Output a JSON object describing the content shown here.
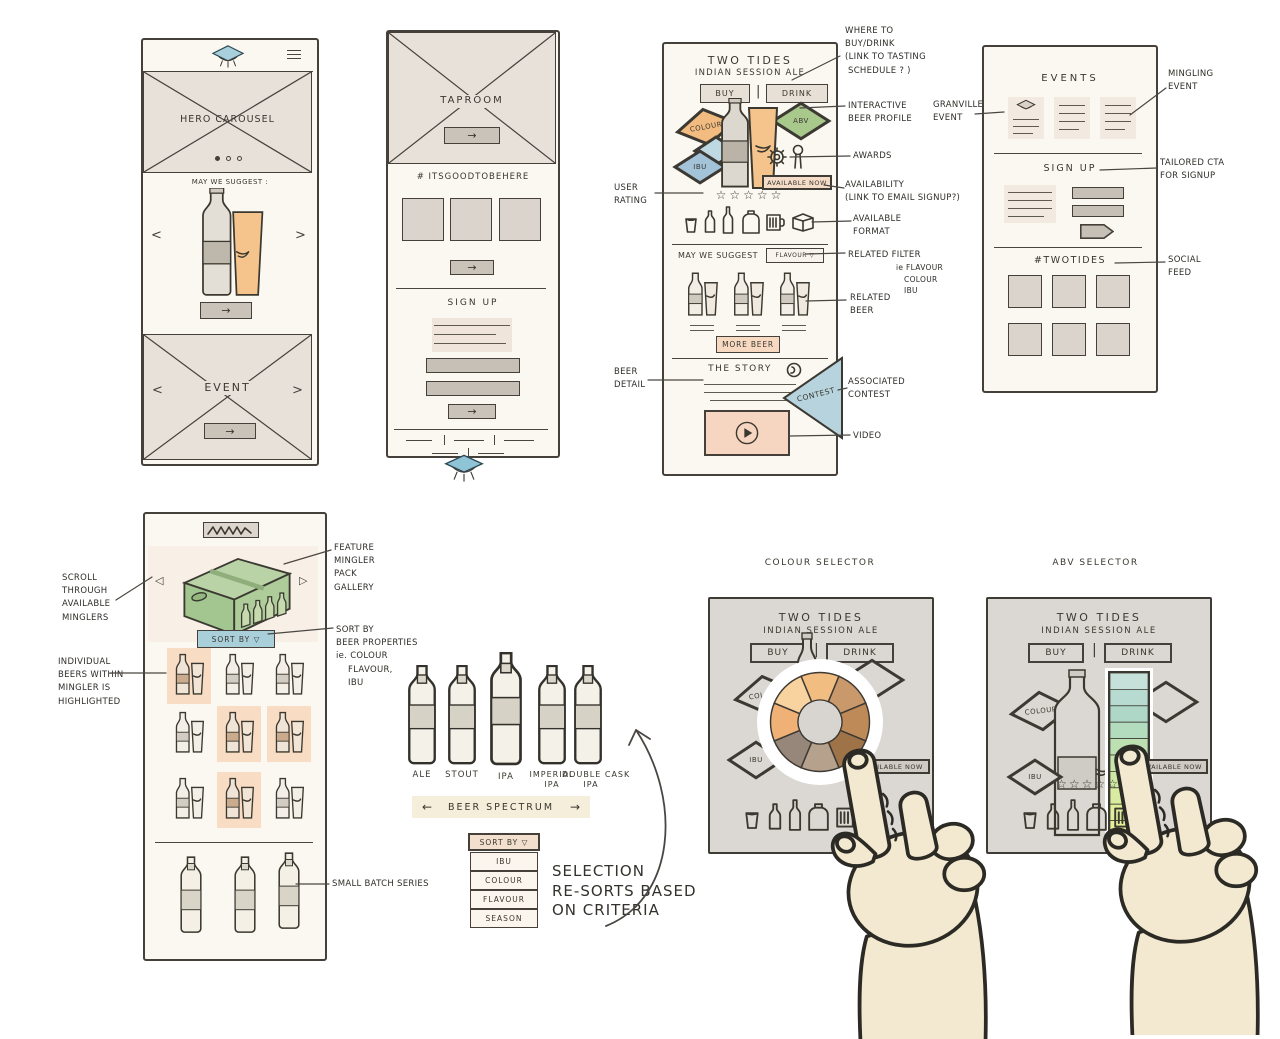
{
  "icons": {
    "right_arrow": "→",
    "left_arrow": "←",
    "prev_chevron": "<",
    "next_chevron": ">",
    "prev_triangle": "◁",
    "next_triangle": "▷",
    "pipe_divider": "|"
  },
  "colors": {
    "ink": "#3a372f",
    "paper": "#fbf7f1",
    "placeholder_gray": "#e8e1da",
    "accent_blue": "#a9cfdd",
    "diamond_orange": "#f2bc80",
    "diamond_green": "#a8c88c",
    "diamond_blue": "#a3c3d9",
    "highlight_peach": "#f9dcc4",
    "video_peach": "#f6d6c0",
    "contest_blue": "#b7d3de",
    "pack_green": "#aecb9a",
    "sort_button_blue": "#a9cfdb",
    "hand_skin": "#f2e9d0",
    "selector_card_gray": "#dbd7d2"
  },
  "phone_home": {
    "hero_label": "HERO CAROUSEL",
    "suggest_heading": "MAY WE SUGGEST :",
    "event_label": "EVENT"
  },
  "phone_taproom": {
    "taproom_label": "TAPROOM",
    "hashtag_heading": "# ITSGOODTOBEHERE",
    "signup_heading": "SIGN UP"
  },
  "phone_beer": {
    "title": "TWO TIDES",
    "subtitle": "INDIAN SESSION ALE",
    "buy_label": "BUY",
    "drink_label": "DRINK",
    "colour_diamond": "COLOUR",
    "abv_diamond": "ABV",
    "ibu_diamond": "IBU",
    "available_now": "AVAILABLE NOW",
    "rating_stars": "☆☆☆☆☆",
    "suggest_heading": "MAY WE SUGGEST",
    "related_filter": "FLAVOUR ▽",
    "more_beer": "MORE BEER",
    "story_heading": "THE STORY",
    "contest_label": "CONTEST"
  },
  "phone_events": {
    "events_heading": "EVENTS",
    "signup_heading": "SIGN UP",
    "hashtag_heading": "#TWOTIDES"
  },
  "phone_mingler": {
    "sort_by_button": "SORT BY   ▽"
  },
  "spectrum": {
    "bottles": [
      "ALE",
      "STOUT",
      "IPA",
      "IMPERIAL\nIPA",
      "DOUBLE CASK\nIPA"
    ],
    "band_label": "BEER SPECTRUM",
    "sort_menu": {
      "header": "SORT BY ▽",
      "items": [
        "IBU",
        "COLOUR",
        "FLAVOUR",
        "SEASON"
      ]
    },
    "note": "SELECTION\nRE-SORTS BASED\nON CRITERIA"
  },
  "selectors": {
    "colour": {
      "caption": "COLOUR SELECTOR",
      "title": "TWO TIDES",
      "subtitle": "INDIAN SESSION ALE",
      "buy_label": "BUY",
      "drink_label": "DRINK",
      "colour_diamond": "COLOUR",
      "ibu_diamond": "IBU",
      "available_now": "AVAILABLE NOW",
      "wheel_segments": [
        "#f2bd80",
        "#c9996b",
        "#bd8a58",
        "#9f7348",
        "#b5a18c",
        "#97867a",
        "#f0b177",
        "#f8d3a0"
      ]
    },
    "abv": {
      "caption": "ABV SELECTOR",
      "title": "TWO TIDES",
      "subtitle": "INDIAN SESSION ALE",
      "buy_label": "BUY",
      "drink_label": "DRINK",
      "colour_diamond": "COLOUR",
      "ibu_diamond": "IBU",
      "available_now": "AVAILABLE NOW",
      "rating_stars": "☆☆☆☆☆",
      "slider_colors": [
        "#c6e0da",
        "#b8dbd1",
        "#aed7c8",
        "#b3dbbe",
        "#bde0b3",
        "#c7e4ab",
        "#d0e8a5",
        "#d8eba0",
        "#dfee9b",
        "#e5f098"
      ]
    }
  },
  "annotations": {
    "beer": {
      "where_to_buy": "WHERE TO\nBUY/DRINK\n(LINK TO TASTING\n SCHEDULE ? )",
      "user_rating": "USER\nRATING",
      "interactive": "INTERACTIVE\nBEER PROFILE",
      "awards": "AWARDS",
      "availability": "AVAILABILITY\n(LINK TO EMAIL SIGNUP?)",
      "format": "AVAILABLE\nFORMAT",
      "related_filter": "RELATED FILTER",
      "related_filter_sub": "ie FLAVOUR\n   COLOUR\n   IBU",
      "related_beer": "RELATED\nBEER",
      "beer_detail": "BEER\nDETAIL",
      "contest": "ASSOCIATED\nCONTEST",
      "video": "VIDEO"
    },
    "events": {
      "granville": "GRANVILLE\nEVENT",
      "mingling": "MINGLING\nEVENT",
      "tailored": "TAILORED CTA\nFOR SIGNUP",
      "social": "SOCIAL\nFEED"
    },
    "mingler": {
      "scroll": "SCROLL\nTHROUGH\nAVAILABLE\nMINGLERS",
      "individual": "INDIVIDUAL\nBEERS WITHIN\nMINGLER IS\nHIGHLIGHTED",
      "feature": "FEATURE\nMINGLER\nPACK\nGALLERY",
      "sort_props": "SORT BY\nBEER PROPERTIES\nie. COLOUR\n    FLAVOUR,\n    IBU",
      "small_batch": "SMALL BATCH SERIES"
    }
  }
}
